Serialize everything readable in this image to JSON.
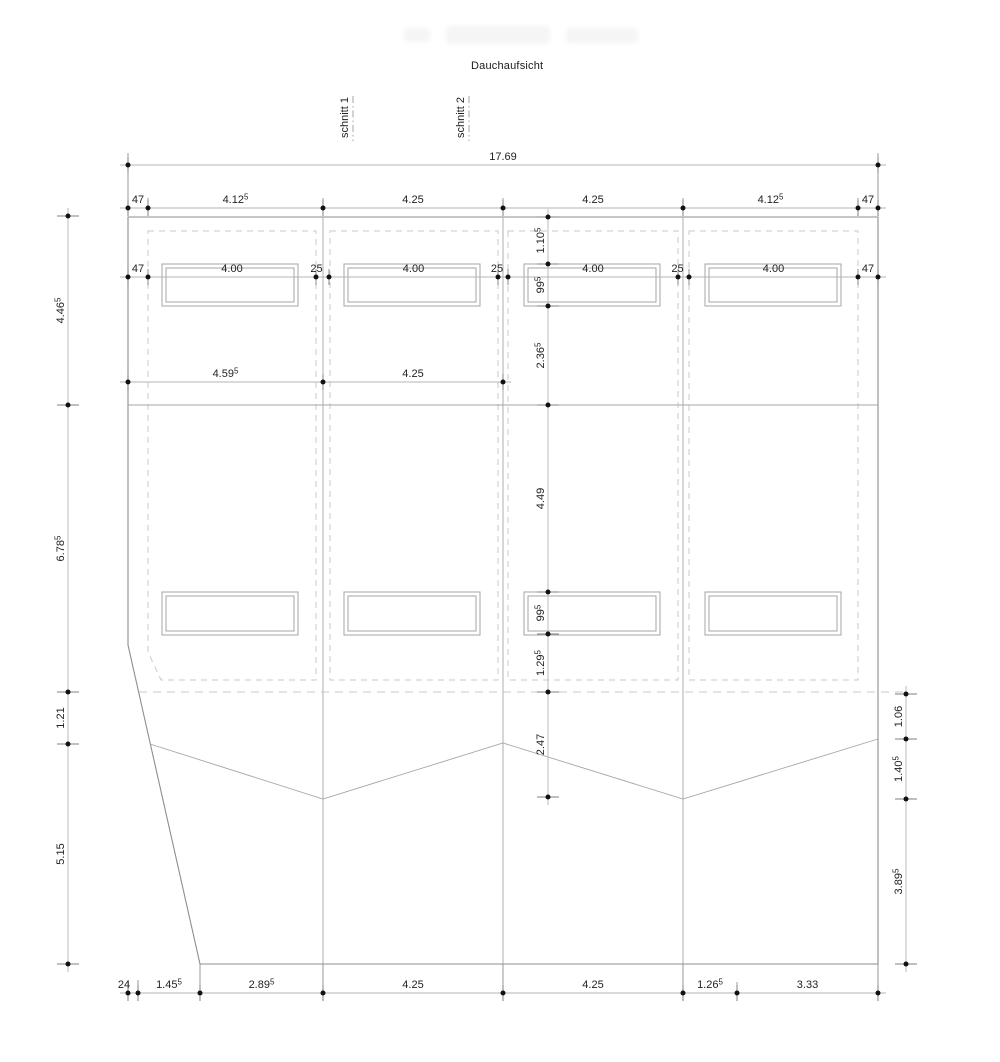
{
  "title": "Dauchaufsicht",
  "colors": {
    "background": "#ffffff",
    "outline": "#8d8d8d",
    "interior": "#a6a6a6",
    "dashed": "#c9c9c9",
    "dim_line": "#b4b4b4",
    "tick": "#7f7f7f",
    "dot": "#111111",
    "text": "#222222"
  },
  "section_markers": [
    {
      "label": "schnitt 1",
      "x": 353,
      "y1": 96,
      "y2": 141
    },
    {
      "label": "schnitt 2",
      "x": 469,
      "y1": 96,
      "y2": 141
    }
  ],
  "building": {
    "outline": [
      [
        128,
        217
      ],
      [
        878,
        217
      ],
      [
        878,
        964
      ],
      [
        200,
        964
      ],
      [
        128,
        645
      ]
    ],
    "dividers": {
      "xs": [
        323,
        503,
        683
      ],
      "y1": 217,
      "y2": 964
    },
    "ridge": {
      "y": 405,
      "x1": 128,
      "x2": 878
    },
    "valley": [
      [
        150,
        744
      ],
      [
        323,
        799
      ],
      [
        503,
        743
      ],
      [
        683,
        799
      ],
      [
        878,
        739
      ]
    ],
    "eaves_dashed": {
      "y": 692,
      "x1": 139,
      "x2": 908
    },
    "bays": [
      [
        [
          148,
          231
        ],
        [
          316,
          231
        ],
        [
          316,
          680
        ],
        [
          161,
          680
        ],
        [
          148,
          652
        ]
      ],
      [
        [
          330,
          231
        ],
        [
          498,
          231
        ],
        [
          498,
          680
        ],
        [
          330,
          680
        ]
      ],
      [
        [
          508,
          231
        ],
        [
          678,
          231
        ],
        [
          678,
          680
        ],
        [
          508,
          680
        ]
      ],
      [
        [
          689,
          231
        ],
        [
          858,
          231
        ],
        [
          858,
          680
        ],
        [
          689,
          680
        ]
      ]
    ],
    "skylights": {
      "rows": [
        {
          "y1": 264,
          "y2": 306
        },
        {
          "y1": 592,
          "y2": 635
        }
      ],
      "xs": [
        [
          162,
          298
        ],
        [
          344,
          480
        ],
        [
          524,
          660
        ],
        [
          705,
          841
        ]
      ],
      "inner_inset": 4
    },
    "extension_lines": [
      [
        128,
        153,
        216
      ],
      [
        878,
        153,
        216
      ],
      [
        148,
        198,
        216
      ],
      [
        323,
        198,
        216
      ],
      [
        503,
        198,
        216
      ],
      [
        683,
        198,
        216
      ],
      [
        858,
        198,
        216
      ],
      [
        200,
        964,
        1001
      ],
      [
        323,
        964,
        1001
      ],
      [
        503,
        964,
        1001
      ],
      [
        683,
        964,
        1001
      ],
      [
        878,
        964,
        1001
      ],
      [
        128,
        980,
        1001
      ],
      [
        138,
        980,
        1001
      ],
      [
        737,
        982,
        1001
      ]
    ]
  },
  "dimension_chains": {
    "horizontal": [
      {
        "name": "overall-width",
        "y": 165,
        "points": [
          128,
          878
        ],
        "labels": [
          "17.69"
        ]
      },
      {
        "name": "bay-widths",
        "y": 208,
        "points": [
          128,
          148,
          323,
          503,
          683,
          858,
          878
        ],
        "labels": [
          "47",
          "4.12^5",
          "4.25",
          "4.25",
          "4.12^5",
          "47"
        ]
      },
      {
        "name": "skylight-widths",
        "y": 277,
        "points": [
          128,
          148,
          316,
          329,
          498,
          508,
          678,
          689,
          858,
          878
        ],
        "labels": [
          "47",
          "4.00",
          {
            "t": "25",
            "dx": -6
          },
          "4.00",
          {
            "t": "25",
            "dx": -6
          },
          "4.00",
          {
            "t": "25",
            "dx": -6
          },
          "4.00",
          "47"
        ]
      },
      {
        "name": "upper-left-widths",
        "y": 382,
        "points": [
          128,
          323,
          503
        ],
        "labels": [
          "4.59^5",
          "4.25"
        ]
      },
      {
        "name": "bottom-widths",
        "y": 993,
        "points": [
          128,
          138,
          200,
          323,
          503,
          683,
          737,
          878
        ],
        "labels": [
          {
            "t": "24",
            "dx": -9
          },
          "1.45^5",
          "2.89^5",
          "4.25",
          "4.25",
          "1.26^5",
          "3.33"
        ]
      }
    ],
    "vertical": [
      {
        "name": "left-heights",
        "x": 68,
        "points": [
          216,
          405,
          692,
          744,
          964
        ],
        "labels": [
          "4.46^5",
          "6.78^5",
          "1.21",
          "5.15"
        ]
      },
      {
        "name": "center-heights",
        "x": 548,
        "points": [
          217,
          264,
          306,
          405,
          592,
          634,
          692,
          797
        ],
        "labels": [
          "1.10^5",
          "99^5",
          "2.36^5",
          "4.49",
          "99^5",
          "1.29^5",
          "2.47"
        ]
      },
      {
        "name": "right-heights",
        "x": 906,
        "points": [
          694,
          739,
          799,
          964
        ],
        "labels": [
          "1.06",
          "1.40^5",
          "3.89^5"
        ]
      }
    ]
  },
  "watermark_blobs": [
    {
      "x": 404,
      "y": 28,
      "w": 26,
      "h": 14
    },
    {
      "x": 446,
      "y": 26,
      "w": 104,
      "h": 18
    },
    {
      "x": 566,
      "y": 28,
      "w": 72,
      "h": 15
    }
  ]
}
